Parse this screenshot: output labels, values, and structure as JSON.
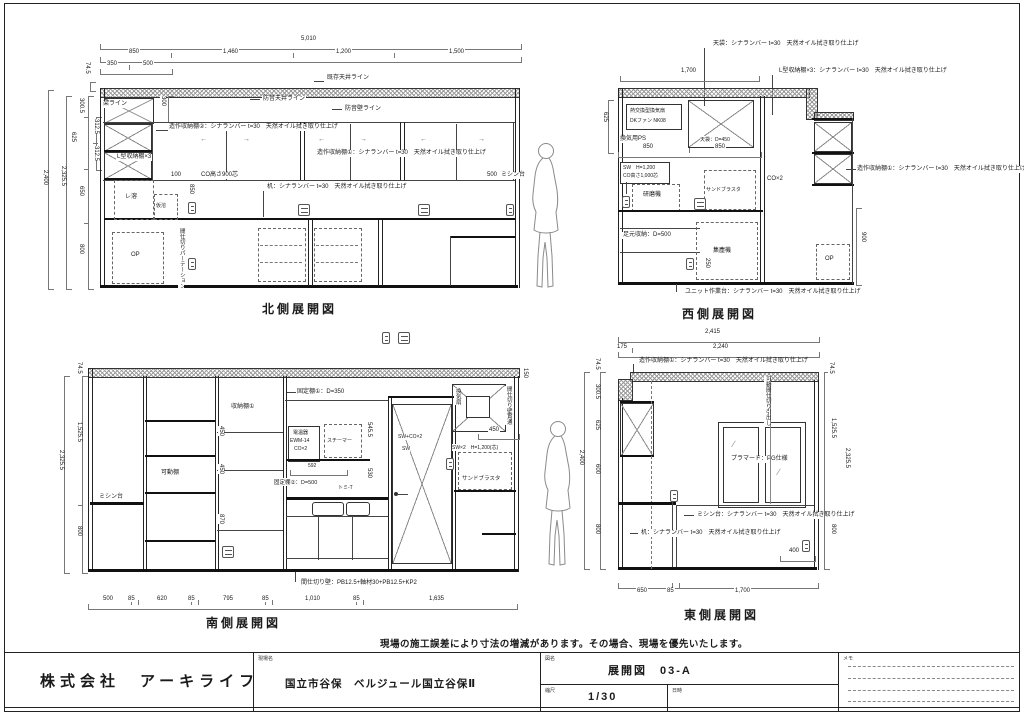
{
  "sheet": {
    "notice": "現場の施工誤差により寸法の増減があります。その場合、現場を優先いたします。"
  },
  "titleblock": {
    "company": "株式会社　アーキライフ",
    "site_label": "現場名",
    "site_name": "国立市谷保　ベルジュール国立谷保Ⅱ",
    "drawing_label": "図名",
    "drawing_name": "展開図　03-A",
    "scale_label": "縮尺",
    "scale_value": "1/30",
    "date_label": "日時",
    "memo_label": "メモ"
  },
  "glyphs": {
    "arrow_left": "←",
    "arrow_right": "→",
    "glass": "∕"
  },
  "north": {
    "title": "北側展開図",
    "dim_total": "5,010",
    "dims_top": [
      "850",
      "1,460",
      "1,200",
      "1,500"
    ],
    "dims_sub": [
      "350",
      "500"
    ],
    "dim_74": "74.5",
    "dim_300_5": "300.5",
    "dim_312a": "312.5",
    "dim_312b": "312.5",
    "dim_625": "625",
    "dim_650": "650",
    "dim_800": "800",
    "dim_2325": "2,325.5",
    "dim_2400": "2,400",
    "dim_300": "300",
    "dim_100": "100",
    "dim_850v": "850",
    "dim_500": "500",
    "existing_ceiling": "既存天井ライン",
    "soundproof_ceiling": "防音天井ライン",
    "soundproof_wall": "防音壁ライン",
    "beam_line": "梁ライン",
    "shelf2": "造作収納棚②：シナランバー t=30　天然オイル拭き取り仕上げ",
    "shelf1": "造作収納棚①：シナランバー t=30　天然オイル拭き取り仕上げ",
    "l_shelf": "L型収納棚×3",
    "co_height": "CO高さ900芯",
    "desk": "机：シナランバー t=30　天然オイル拭き取り仕上げ",
    "sewing": "ミシン台",
    "box_a": "レ溶",
    "box_b": "仮溶",
    "op": "OP",
    "partition_v": "間仕切りパーテーション"
  },
  "west": {
    "title": "西側展開図",
    "dim_1700": "1,700",
    "dim_850a": "850",
    "dim_850b": "850",
    "dim_625": "625",
    "dim_900": "900",
    "dim_250": "250",
    "tenbukuro_callout": "天袋：シナランバー t=30　天然オイル拭き取り仕上げ",
    "l_shelf_callout": "L型収納棚×3：シナランバー t=30　天然オイル拭き取り仕上げ",
    "heat_ex1": "熱交換型換気扇",
    "heat_ex2": "DKファン NK08",
    "vent_ps": "換気用PS",
    "tenbukuro": "天袋：D=450",
    "sw": "SW　H=1,200",
    "co_h": "CO高さ1,000芯",
    "grinder": "研磨機",
    "sandblaster": "サンドブラスタ",
    "co2": "CO×2",
    "shelf1": "造作収納棚①：シナランバー t=30　天然オイル拭き取り仕上げ",
    "foot": "足元収納：D=500",
    "dust": "集塵機",
    "op": "OP",
    "unit": "ユニット作業台：シナランバー t=30　天然オイル拭き取り仕上げ"
  },
  "east": {
    "title": "東側展開図",
    "dim_total": "2,415",
    "dim_175": "175",
    "dim_2240": "2,240",
    "dim_74l": "74.5",
    "dim_300_5": "300.5",
    "dim_625": "625",
    "dim_600": "600",
    "dim_800l": "800",
    "dim_2400": "2,400",
    "dim_74r": "74.5",
    "dim_1525": "1,525.5",
    "dim_2325": "2,325.5",
    "dim_800r": "800",
    "dim_400": "400",
    "dims_bottom": [
      "650",
      "85",
      "1,700"
    ],
    "shelf1": "造作収納棚①：シナランバー t=30　天然オイル拭き取り仕上げ",
    "pg": "プラマード：PG仕様",
    "sewing": "ミシン台：シナランバー t=30　天然オイル拭き取り仕上げ",
    "desk": "机：シナランバー t=30　天然オイル拭き取り仕上げ",
    "movable_v": "可動間仕切り引出し"
  },
  "south": {
    "title": "南側展開図",
    "dim_74": "74.5",
    "dim_1525": "1,525.5",
    "dim_2325": "2,325.5",
    "dim_800": "800",
    "dim_450a": "450",
    "dim_450b": "450",
    "dim_870": "870",
    "dim_450fan": "450",
    "dim_150": "150",
    "dim_592": "592",
    "dim_545": "545.5",
    "dim_530": "530",
    "dims_bottom": [
      "500",
      "85",
      "620",
      "85",
      "795",
      "85",
      "1,010",
      "85",
      "1,635"
    ],
    "fixed1": "固定棚①：D=350",
    "storage1": "収納棚①",
    "movable": "可動棚",
    "sewing": "ミシン台",
    "heater1": "電温器",
    "heater2": "EWM-14",
    "heater3": "CO×2",
    "steamer": "スチーマー",
    "fixed2": "固定棚②：D=500",
    "tap": "トミ-T",
    "sw_co": "SW+CO×2",
    "sw": "SW",
    "fan": "換気扇",
    "fan_v": "間仕切り壁貫通",
    "sw2": "SW×2　H=1,200(芯)",
    "sandblaster": "サンドブラスタ",
    "partition": "間仕切り壁：PB12.5+軸材30+PB12.5+KP2"
  }
}
